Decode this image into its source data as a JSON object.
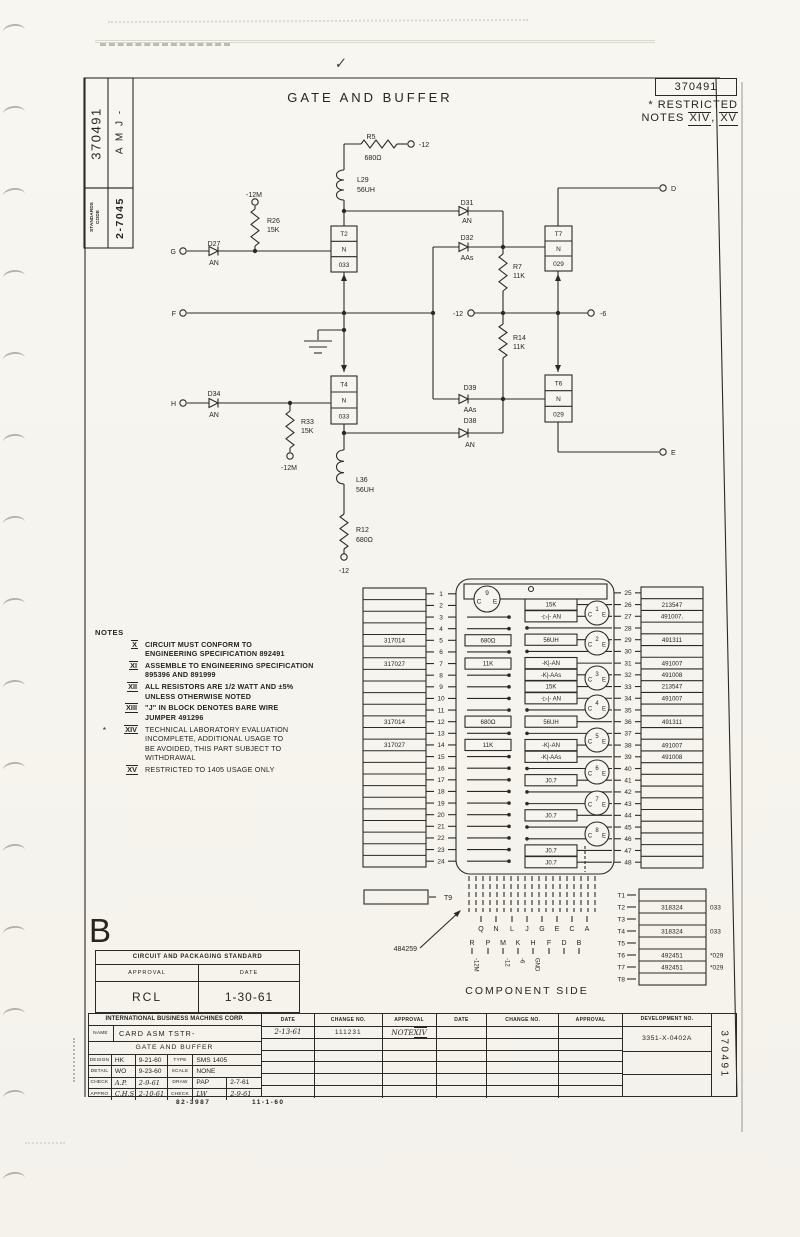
{
  "header": {
    "doc_number": "370491",
    "restricted_star": "*",
    "restricted_word": "RESTRICTED",
    "notes_prefix": "NOTES",
    "notes_sep": ", ",
    "restricted_note_1": "XIV",
    "restricted_note_2": "XV",
    "title": "GATE AND BUFFER",
    "check_mark": "✓"
  },
  "stamp": {
    "number": "370491",
    "code_letters": "A M J -",
    "standards_line1": "STANDARDS",
    "standards_line2": "CODE",
    "standards_value": "2-7045"
  },
  "schematic": {
    "g": "G",
    "f": "F",
    "h": "H",
    "d": "D",
    "e": "E",
    "r5": "R5",
    "r5_val": "680Ω",
    "r5_supply": "-12",
    "l29": "L29",
    "l29_val": "56UH",
    "r26": "R26",
    "r26_val": "15K",
    "r26_supply": "-12M",
    "d27": "D27",
    "d27_type": "AN",
    "t2_1": "T2",
    "t2_2": "N",
    "t2_3": "033",
    "d31": "D31",
    "d31_type": "AN",
    "d32": "D32",
    "d32_type": "AAs",
    "r7": "R7",
    "r7_val": "11K",
    "t7_1": "T7",
    "t7_2": "N",
    "t7_3": "029",
    "mid_supply_left": "-12",
    "mid_supply_right": "-6",
    "r14": "R14",
    "r14_val": "11K",
    "d34": "D34",
    "d34_type": "AN",
    "r33": "R33",
    "r33_val": "15K",
    "r33_supply": "-12M",
    "t4_1": "T4",
    "t4_2": "N",
    "t4_3": "033",
    "d39": "D39",
    "d39_type": "AAs",
    "d38": "D38",
    "d38_type": "AN",
    "t6_1": "T6",
    "t6_2": "N",
    "t6_3": "029",
    "l36": "L36",
    "l36_val": "56UH",
    "r12": "R12",
    "r12_val": "680Ω",
    "r12_supply": "-12"
  },
  "notes": {
    "heading": "NOTES",
    "items": [
      {
        "star": "",
        "num": "X",
        "lines": [
          "CIRCUIT MUST CONFORM TO",
          "ENGINEERING SPECIFICATION 892491"
        ]
      },
      {
        "star": "",
        "num": "XI",
        "lines": [
          "ASSEMBLE TO ENGINEERING SPECIFICATION",
          "895396 AND 891999"
        ]
      },
      {
        "star": "",
        "num": "XII",
        "lines": [
          "ALL RESISTORS ARE 1/2 WATT AND ±5%",
          "UNLESS OTHERWISE NOTED"
        ]
      },
      {
        "star": "",
        "num": "XIII",
        "lines": [
          "\"J\" IN BLOCK DENOTES BARE WIRE",
          "JUMPER 491296"
        ]
      },
      {
        "star": "*",
        "num": "XIV",
        "lines": [
          "TECHNICAL LABORATORY EVALUATION",
          "INCOMPLETE, ADDITIONAL USAGE TO",
          "BE AVOIDED, THIS PART SUBJECT TO",
          "WITHDRAWAL"
        ]
      },
      {
        "star": "",
        "num": "XV",
        "lines": [
          "RESTRICTED TO 1405 USAGE ONLY"
        ]
      }
    ]
  },
  "card": {
    "left_labels": {
      "5": "317014",
      "7": "317027",
      "12": "317014",
      "14": "317027"
    },
    "right_labels": {
      "26": "213547",
      "27": "491007.",
      "29": "491311",
      "31": "491007",
      "32": "491008",
      "33": "213547",
      "34": "491007",
      "36": "491311",
      "38": "491007",
      "39": "491008"
    },
    "inner_left": [
      {
        "row": 5,
        "label": "680Ω"
      },
      {
        "row": 7,
        "label": "11K"
      },
      {
        "row": 12,
        "label": "680Ω"
      },
      {
        "row": 14,
        "label": "11K"
      }
    ],
    "inner_mid": [
      {
        "row": 26,
        "label": "15K"
      },
      {
        "row": 27,
        "label": "-▷|- AN"
      },
      {
        "row": 29,
        "label": "56UH"
      },
      {
        "row": 31,
        "label": "-K|-AN"
      },
      {
        "row": 32,
        "label": "-K|-AAs"
      },
      {
        "row": 33,
        "label": "15K"
      },
      {
        "row": 34,
        "label": "-▷|- AN"
      },
      {
        "row": 36,
        "label": "56UH"
      },
      {
        "row": 38,
        "label": "-K|-AN"
      },
      {
        "row": 39,
        "label": "-K|-AAs"
      },
      {
        "row": 41,
        "label": "J0.7"
      },
      {
        "row": 44,
        "label": "J0.7"
      },
      {
        "row": 47,
        "label": "J0.7"
      },
      {
        "row": 48,
        "label": "J0.7"
      }
    ],
    "transistor_c": "C",
    "transistor_e": "E",
    "transistors": [
      "1",
      "2",
      "3",
      "4",
      "5",
      "6",
      "7",
      "8"
    ],
    "top_transistor": "9",
    "t9": "T9",
    "connector_part": "484259",
    "letters_top": [
      "Q",
      "N",
      "L",
      "J",
      "G",
      "E",
      "C",
      "A"
    ],
    "letters_bottom": [
      "R",
      "P",
      "M",
      "K",
      "H",
      "F",
      "D",
      "B"
    ],
    "signals": [
      {
        "letter": "R",
        "label": "-12M"
      },
      {
        "letter": "M",
        "label": "-12"
      },
      {
        "letter": "K",
        "label": "-6"
      },
      {
        "letter": "H",
        "label": "GND"
      }
    ],
    "caption": "COMPONENT SIDE",
    "t_table": [
      {
        "t": "T1",
        "val": "",
        "note": ""
      },
      {
        "t": "T2",
        "val": "318324",
        "note": "033"
      },
      {
        "t": "T3",
        "val": "",
        "note": ""
      },
      {
        "t": "T4",
        "val": "318324",
        "note": "033"
      },
      {
        "t": "T5",
        "val": "",
        "note": ""
      },
      {
        "t": "T6",
        "val": "492451",
        "note": "*029"
      },
      {
        "t": "T7",
        "val": "492451",
        "note": "*029"
      },
      {
        "t": "T8",
        "val": "",
        "note": ""
      }
    ]
  },
  "revision": {
    "letter": "B"
  },
  "packaging": {
    "title": "CIRCUIT AND PACKAGING STANDARD",
    "approval_label": "APPROVAL",
    "date_label": "DATE",
    "approval": "RCL",
    "date": "1-30-61"
  },
  "titleblock": {
    "company": "INTERNATIONAL BUSINESS MACHINES CORP.",
    "name_label": "NAME",
    "name_value": "CARD ASM TSTR-",
    "name_value2": "GATE AND BUFFER",
    "rows": [
      {
        "l1": "DESIGN",
        "v1": "HK",
        "d1": "9-21-60",
        "l2": "TYPE",
        "v2": "SMS",
        "d2": "1405",
        "hand": false,
        "hand2": false
      },
      {
        "l1": "DETAIL",
        "v1": "WO",
        "d1": "9-23-60",
        "l2": "SCALE",
        "v2": "NONE",
        "d2": "",
        "hand": false,
        "hand2": false
      },
      {
        "l1": "CHECK",
        "v1": "A.P.",
        "d1": "2-9-61",
        "l2": "DRAW",
        "v2": "PAP",
        "d2": "2-7-61",
        "hand": true,
        "hand2": false
      },
      {
        "l1": "APPRO",
        "v1": "C.H.S",
        "d1": "2-10-61",
        "l2": "CHECK",
        "v2": "LW",
        "d2": "2-9-61",
        "hand": true,
        "hand2": true
      }
    ],
    "change_headers": [
      "DATE",
      "CHANGE NO.",
      "APPROVAL",
      "DATE",
      "CHANGE NO.",
      "APPROVAL"
    ],
    "change_date": "2-13-61",
    "change_no": "111231",
    "change_approval_prefix": "NOTE",
    "change_approval_num": "XIV",
    "dev_label": "DEVELOPMENT NO.",
    "dev_value": "3351-X-0402A",
    "side_number": "370491",
    "form_left": "82-3987",
    "form_right": "11-1-60"
  }
}
